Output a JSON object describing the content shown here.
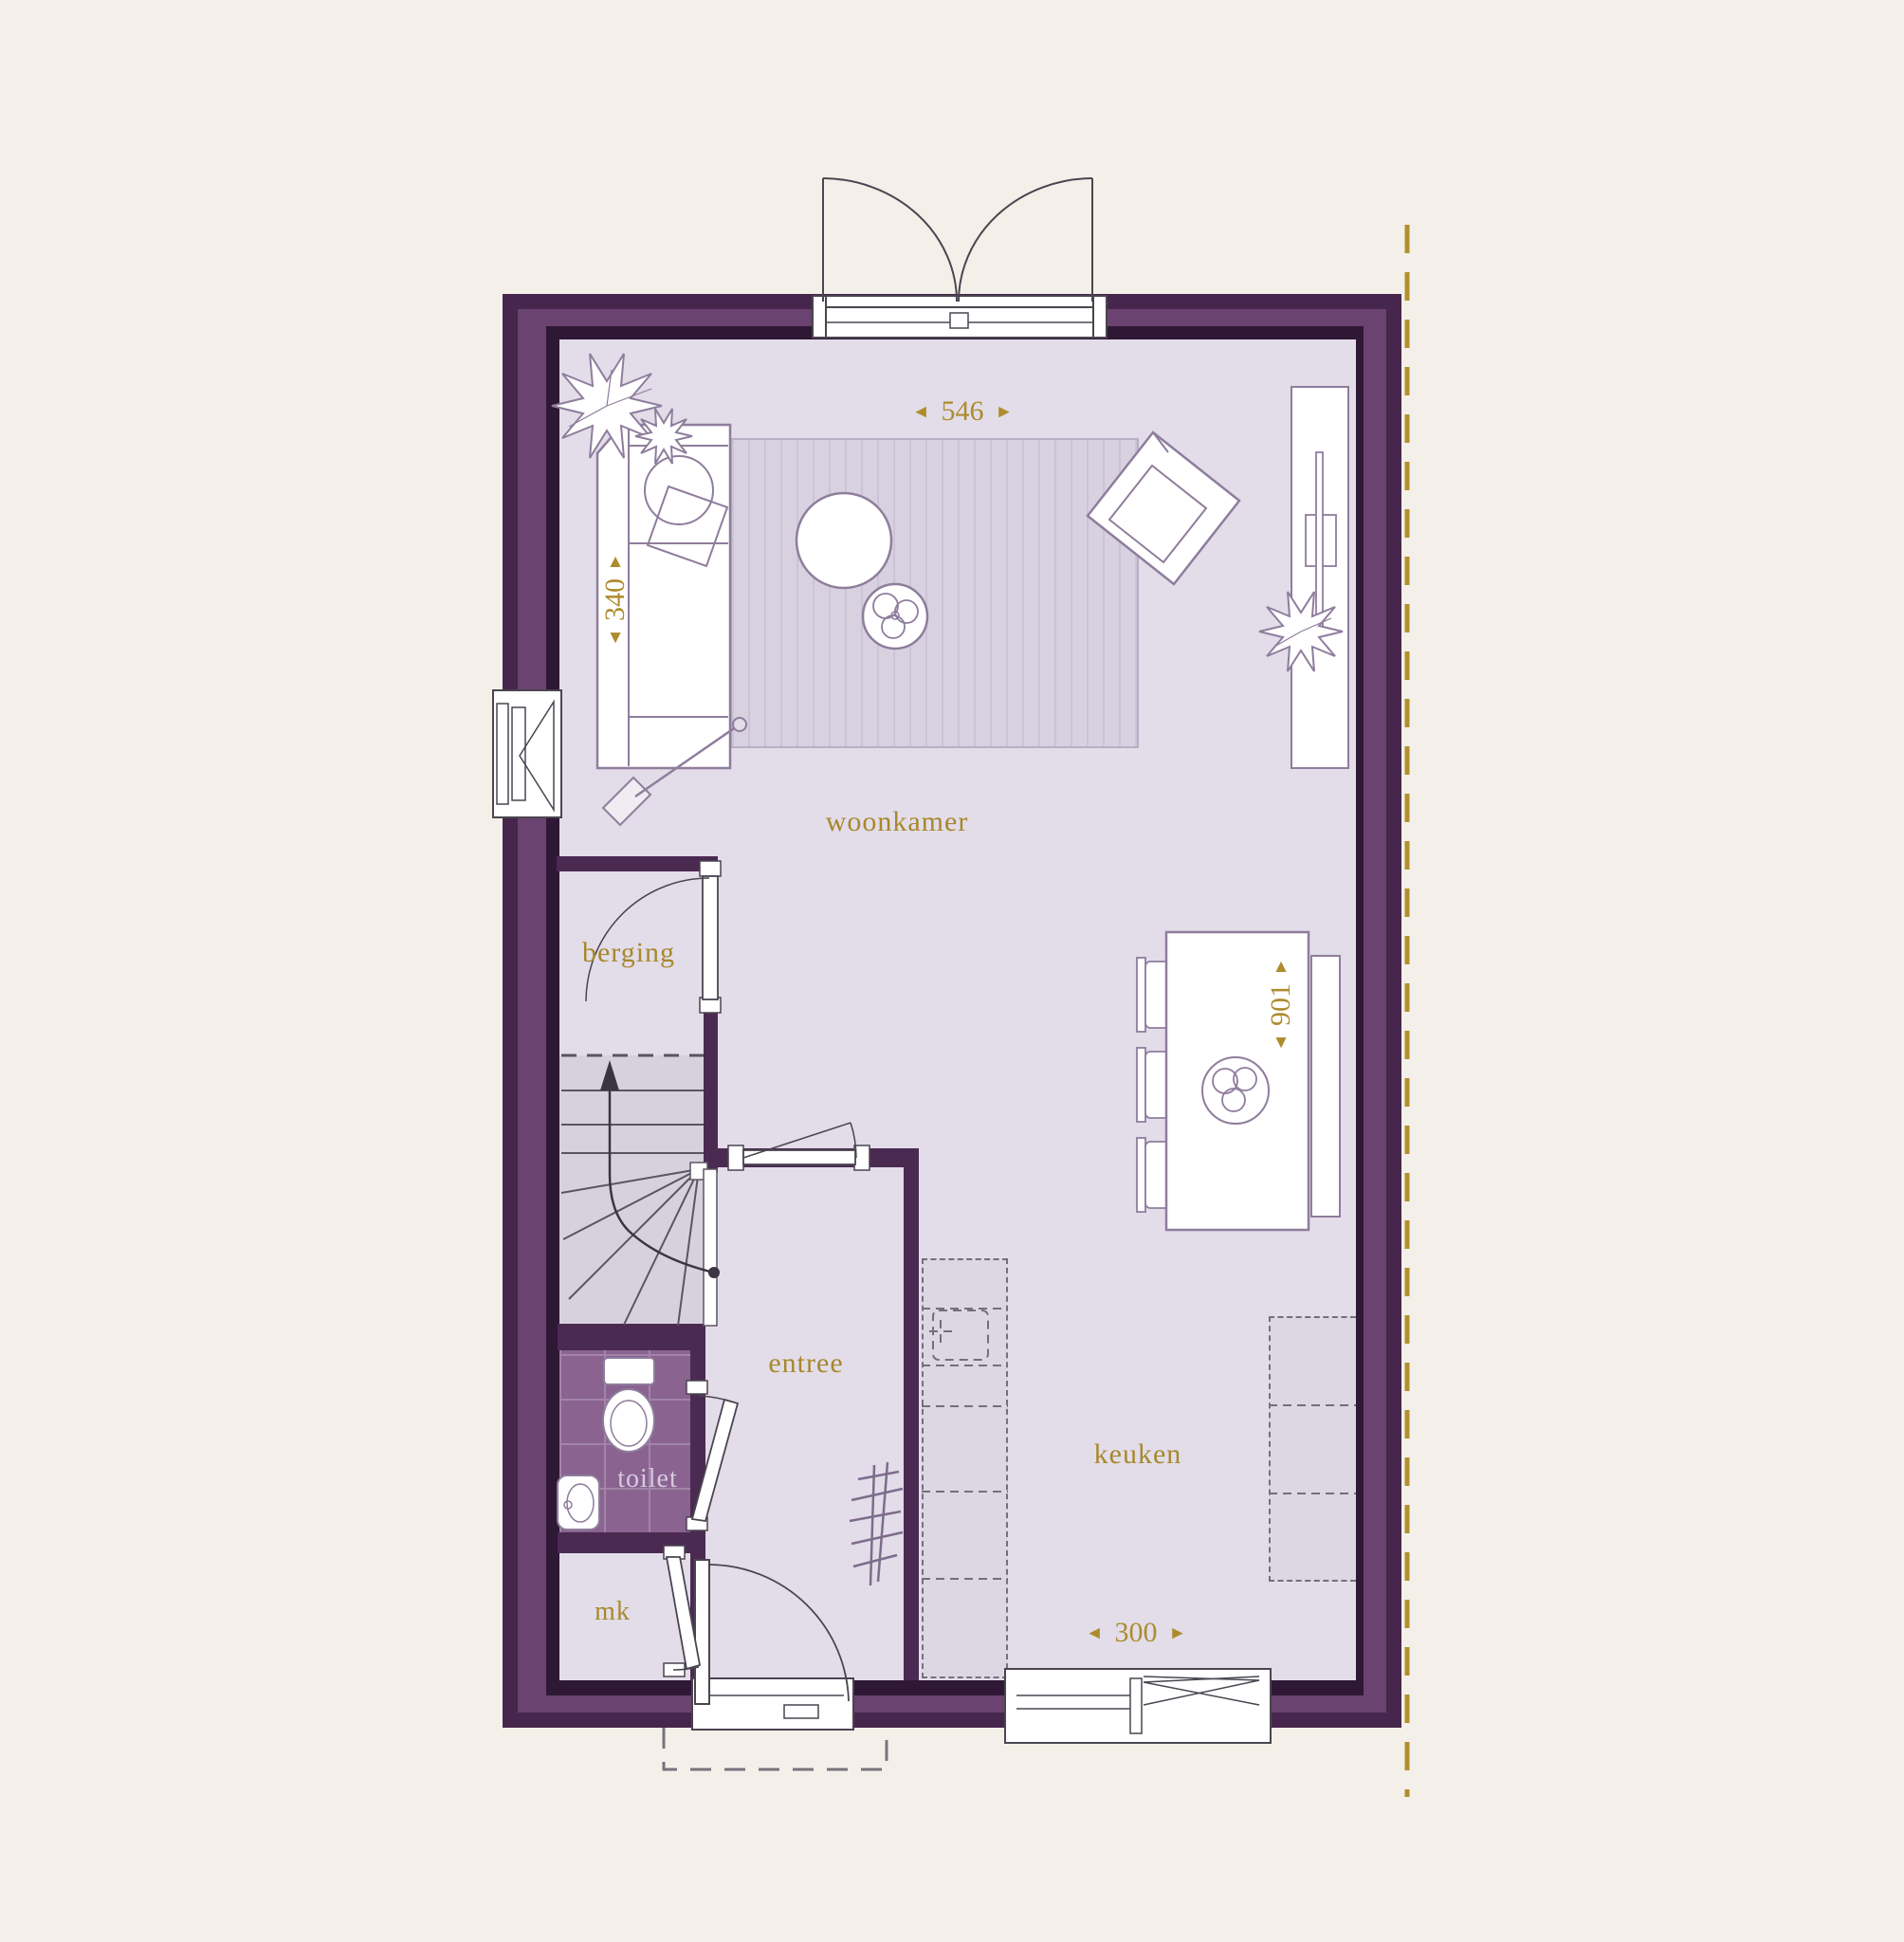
{
  "plan_title": "ground-floor-plan",
  "rooms": {
    "living": "woonkamer",
    "storage": "berging",
    "hall": "entree",
    "toilet": "toilet",
    "meter_cupboard": "mk",
    "kitchen": "keuken"
  },
  "dimensions": {
    "top_width": "546",
    "left_depth": "340",
    "right_depth": "901",
    "kitchen_width": "300"
  },
  "icons": {
    "arrow_left": "◄",
    "arrow_right": "►",
    "arrow_up": "▲",
    "arrow_down": "▼"
  },
  "palette": {
    "background": "#f4f0e9",
    "wall_dark": "#46264c",
    "wall_mid": "#6a4371",
    "wall_edge": "#2f1736",
    "floor": "#e2dde9",
    "rug": "#d8d2e0",
    "tiles": "#8a6390",
    "stairs": "#d7d1de",
    "gold": "#ad8c2e",
    "furniture_line": "#8f7d9c",
    "toilet_label": "#d6cbdf"
  }
}
